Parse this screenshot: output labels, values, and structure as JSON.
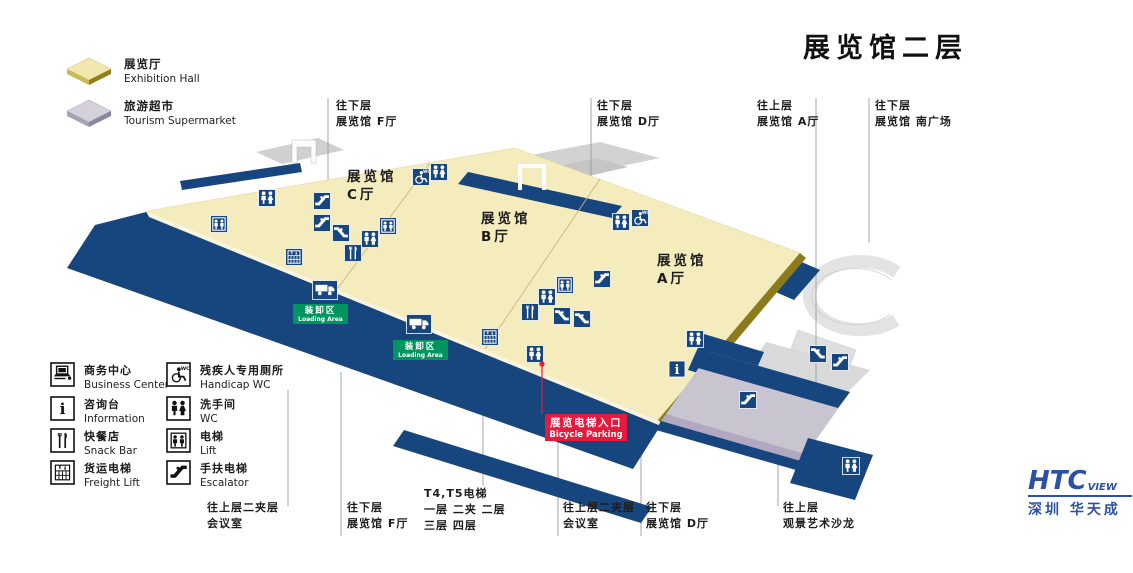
{
  "title": "展览馆二层",
  "legend_top": {
    "exhibition": {
      "cn": "展览厅",
      "en": "Exhibition Hall"
    },
    "supermarket": {
      "cn": "旅游超市",
      "en": "Tourism Supermarket"
    }
  },
  "legend": [
    {
      "cn": "商务中心",
      "en": "Business Center",
      "icon": "business-center"
    },
    {
      "cn": "咨询台",
      "en": "Information",
      "icon": "information"
    },
    {
      "cn": "快餐店",
      "en": "Snack Bar",
      "icon": "snack-bar"
    },
    {
      "cn": "货运电梯",
      "en": "Freight Lift",
      "icon": "freight-lift"
    },
    {
      "cn": "残疾人专用厕所",
      "en": "Handicap WC",
      "icon": "handicap-wc"
    },
    {
      "cn": "洗手间",
      "en": "WC",
      "icon": "wc"
    },
    {
      "cn": "电梯",
      "en": "Lift",
      "icon": "lift"
    },
    {
      "cn": "手扶电梯",
      "en": "Escalator",
      "icon": "escalator"
    }
  ],
  "halls": {
    "c": {
      "name": "展览馆",
      "hall": "C厅"
    },
    "b": {
      "name": "展览馆",
      "hall": "B厅"
    },
    "a": {
      "name": "展览馆",
      "hall": "A厅"
    }
  },
  "callouts_top": [
    {
      "line1": "往下层",
      "line2": "展览馆 F厅"
    },
    {
      "line1": "往下层",
      "line2": "展览馆 D厅"
    },
    {
      "line1": "往上层",
      "line2": "展览馆 A厅"
    },
    {
      "line1": "往下层",
      "line2": "展览馆 南广场"
    }
  ],
  "callouts_bottom": [
    {
      "line1": "往上层二夹层",
      "line2": "会议室"
    },
    {
      "line1": "往下层",
      "line2": "展览馆 F厅"
    },
    {
      "line1": "T4,T5电梯",
      "line2": "一层  二夹  二层",
      "line3": "三层  四层"
    },
    {
      "line1": "往上层二夹层",
      "line2": "会议室"
    },
    {
      "line1": "往下层",
      "line2": "展览馆 D厅"
    },
    {
      "line1": "往上层",
      "line2": "观景艺术沙龙"
    }
  ],
  "map_labels": {
    "loading_area_cn": "装卸区",
    "loading_area_en": "Loading Area",
    "bicycle_cn": "展览电梯入口",
    "bicycle_en": "Bicycle Parking"
  },
  "map_icons": [
    {
      "type": "lift",
      "x": 219,
      "y": 224
    },
    {
      "type": "wc",
      "x": 267,
      "y": 198
    },
    {
      "type": "escalator",
      "x": 322,
      "y": 201
    },
    {
      "type": "escalator",
      "x": 322,
      "y": 223
    },
    {
      "type": "escalator-down",
      "x": 341,
      "y": 233
    },
    {
      "type": "lift",
      "x": 388,
      "y": 226
    },
    {
      "type": "wc",
      "x": 370,
      "y": 239
    },
    {
      "type": "snack-bar",
      "x": 353,
      "y": 253
    },
    {
      "type": "freight-lift",
      "x": 294,
      "y": 257
    },
    {
      "type": "truck",
      "x": 325,
      "y": 290
    },
    {
      "type": "truck",
      "x": 419,
      "y": 324
    },
    {
      "type": "handicap-wc",
      "x": 421,
      "y": 177
    },
    {
      "type": "wc",
      "x": 439,
      "y": 172
    },
    {
      "type": "wc",
      "x": 621,
      "y": 222
    },
    {
      "type": "handicap-wc",
      "x": 640,
      "y": 218
    },
    {
      "type": "escalator",
      "x": 602,
      "y": 279
    },
    {
      "type": "lift",
      "x": 565,
      "y": 285
    },
    {
      "type": "wc",
      "x": 547,
      "y": 297
    },
    {
      "type": "snack-bar",
      "x": 530,
      "y": 312
    },
    {
      "type": "escalator-down",
      "x": 562,
      "y": 316
    },
    {
      "type": "escalator-down",
      "x": 582,
      "y": 319
    },
    {
      "type": "freight-lift",
      "x": 490,
      "y": 337
    },
    {
      "type": "wc",
      "x": 535,
      "y": 354
    },
    {
      "type": "wc",
      "x": 695,
      "y": 339
    },
    {
      "type": "information",
      "x": 677,
      "y": 369
    },
    {
      "type": "escalator",
      "x": 748,
      "y": 400
    },
    {
      "type": "escalator-down",
      "x": 818,
      "y": 354
    },
    {
      "type": "escalator",
      "x": 840,
      "y": 362
    },
    {
      "type": "wc",
      "x": 851,
      "y": 466
    }
  ],
  "logo": {
    "htc": "HTC",
    "view": "VIEW",
    "tagline": "深圳 华天成"
  },
  "colors": {
    "navy": "#17457E",
    "floor_yellow": "#F5ECBE",
    "green": "#009460",
    "red": "#E51A3C",
    "supermarket_gray": "#C8C5D1",
    "logo_blue": "#2B50A5"
  }
}
